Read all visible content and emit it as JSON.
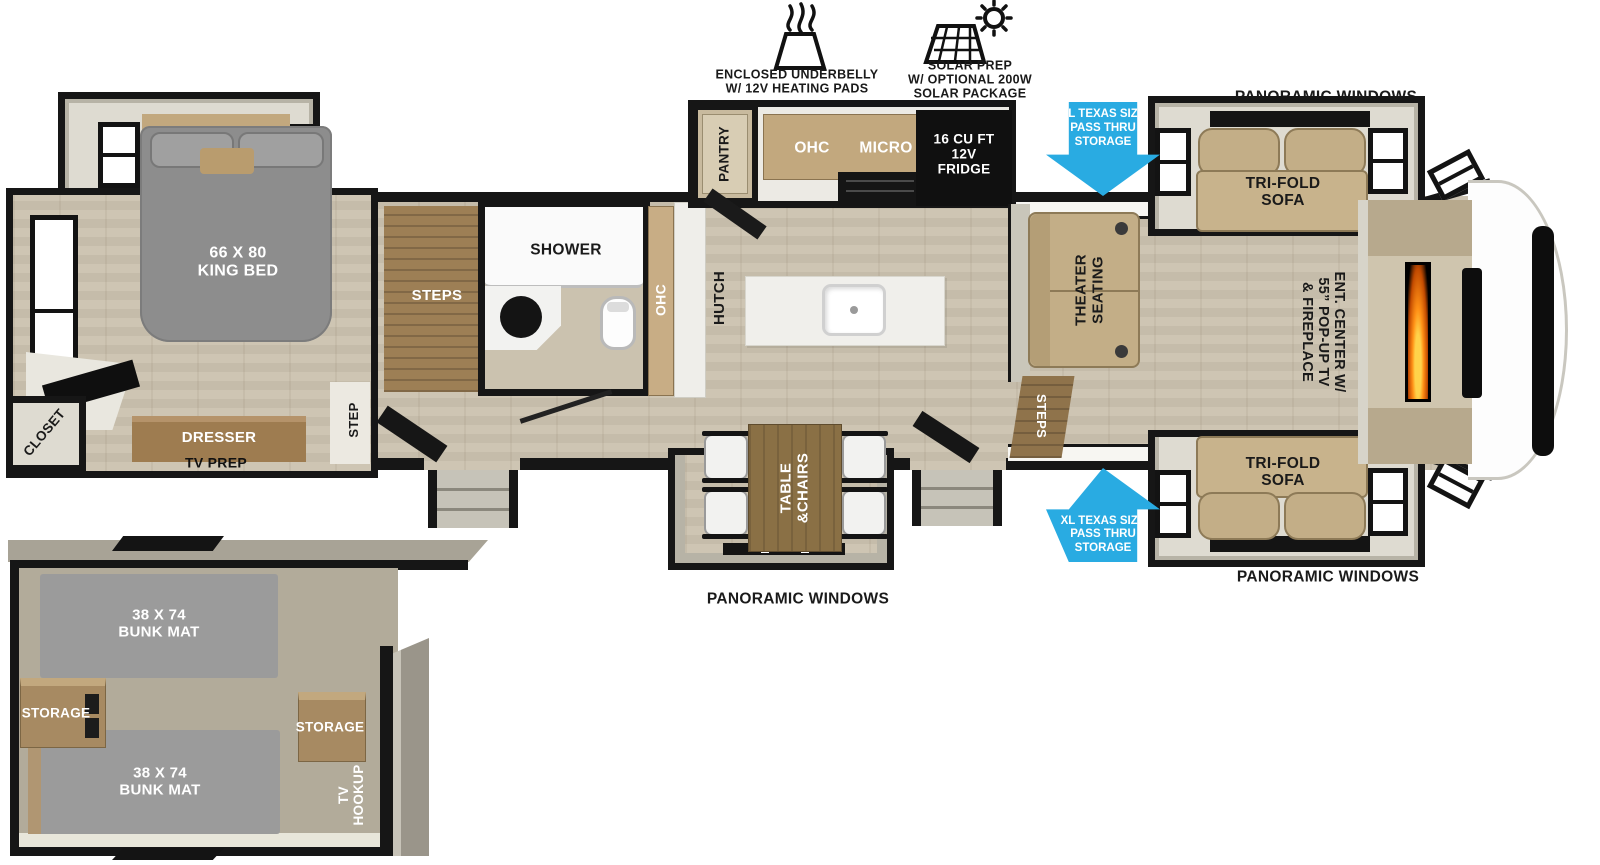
{
  "features": {
    "underbelly": "ENCLOSED UNDERBELLY\nW/ 12V HEATING PADS",
    "solar": "SOLAR PREP\nW/ OPTIONAL 200W\nSOLAR PACKAGE"
  },
  "exterior": {
    "panoramic_windows_top": "PANORAMIC WINDOWS",
    "panoramic_windows_bottom_right": "PANORAMIC WINDOWS",
    "panoramic_windows_bottom_center": "PANORAMIC WINDOWS",
    "pass_thru_top": "XL TEXAS SIZE\nPASS THRU\nSTORAGE",
    "pass_thru_bottom": "XL TEXAS SIZE\nPASS THRU\nSTORAGE"
  },
  "bedroom": {
    "king_bed": "66 X 80\nKING BED",
    "closet": "CLOSET",
    "dresser": "DRESSER",
    "tv_prep": "TV PREP",
    "step": "STEP"
  },
  "bathroom": {
    "steps": "STEPS",
    "shower": "SHOWER",
    "ohc": "OHC"
  },
  "kitchen": {
    "pantry": "PANTRY",
    "ohc": "OHC",
    "micro": "MICRO",
    "fridge": "16 CU FT\n12V\nFRIDGE",
    "hutch": "HUTCH"
  },
  "living": {
    "theater_seating": "THEATER\nSEATING",
    "steps": "STEPS",
    "tri_fold_sofa_top": "TRI-FOLD\nSOFA",
    "tri_fold_sofa_bottom": "TRI-FOLD\nSOFA",
    "ent_center": "ENT. CENTER W/\n55” POP-UP TV\n& FIREPLACE"
  },
  "dinette": {
    "table_chairs": "TABLE\n&CHAIRS"
  },
  "bunk_room": {
    "bunk_top": "38 X 74\nBUNK MAT",
    "bunk_bottom": "38 X 74\nBUNK MAT",
    "storage_left": "STORAGE",
    "storage_right": "STORAGE",
    "tv_hookup": "TV\nHOOKUP"
  },
  "colors": {
    "accent_blue": "#29abe2",
    "wall_black": "#161616",
    "floor_wood": "#cbc2af",
    "cabinet_wood": "#a78a62",
    "sofa_tan": "#c3ae87",
    "mattress_gray": "#8f8f8f"
  }
}
